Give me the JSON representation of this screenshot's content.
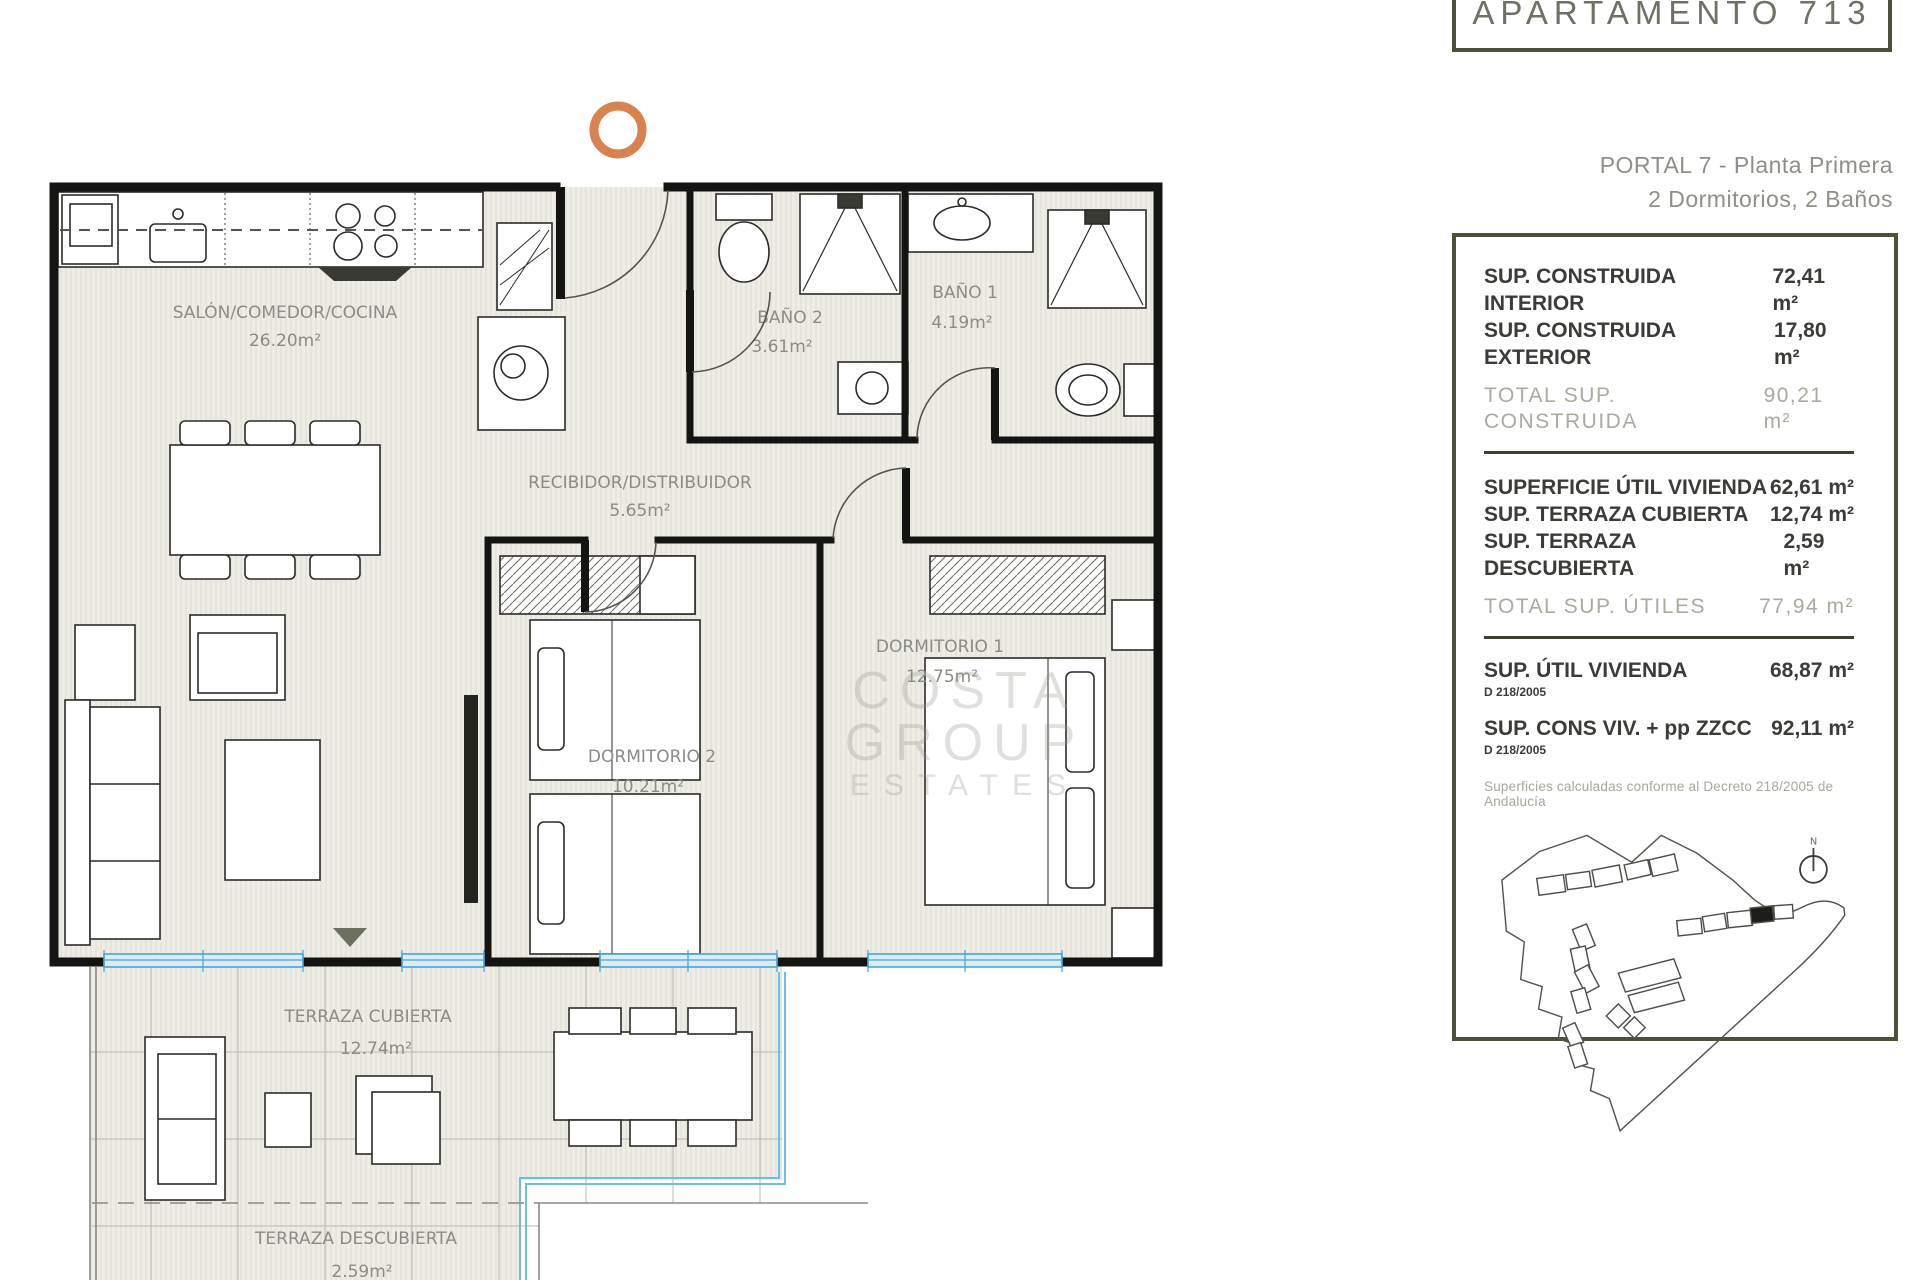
{
  "header": {
    "title": "APARTAMENTO 713",
    "portal_line1": "PORTAL 7 - Planta Primera",
    "portal_line2": "2 Dormitorios, 2 Baños"
  },
  "panel": {
    "construida": [
      {
        "label": "SUP. CONSTRUIDA INTERIOR",
        "value": "72,41 m²"
      },
      {
        "label": "SUP. CONSTRUIDA EXTERIOR",
        "value": "17,80 m²"
      }
    ],
    "total_construida": {
      "label": "TOTAL SUP. CONSTRUIDA",
      "value": "90,21 m²"
    },
    "utiles": [
      {
        "label": "SUPERFICIE ÚTIL VIVIENDA",
        "value": "62,61 m²"
      },
      {
        "label": "SUP. TERRAZA CUBIERTA",
        "value": "12,74 m²"
      },
      {
        "label": "SUP. TERRAZA DESCUBIERTA",
        "value": "2,59 m²"
      }
    ],
    "total_utiles": {
      "label": "TOTAL SUP. ÚTILES",
      "value": "77,94 m²"
    },
    "decreto": [
      {
        "label": "SUP. ÚTIL VIVIENDA",
        "sub": "D 218/2005",
        "value": "68,87 m²"
      },
      {
        "label": "SUP. CONS VIV. + pp ZZCC",
        "sub": "D 218/2005",
        "value": "92,11 m²"
      }
    ],
    "footnote": "Superficies calculadas conforme al Decreto 218/2005 de Andalucía"
  },
  "rooms": {
    "salon": {
      "name": "SALÓN/COMEDOR/COCINA",
      "area": "26.20m²"
    },
    "recibidor": {
      "name": "RECIBIDOR/DISTRIBUIDOR",
      "area": "5.65m²"
    },
    "bano2": {
      "name": "BAÑO 2",
      "area": "3.61m²"
    },
    "bano1": {
      "name": "BAÑO 1",
      "area": "4.19m²"
    },
    "dormitorio1": {
      "name": "DORMITORIO 1",
      "area": "12.75m²"
    },
    "dormitorio2": {
      "name": "DORMITORIO 2",
      "area": "10.21m²"
    },
    "terraza_cubierta": {
      "name": "TERRAZA CUBIERTA",
      "area": "12.74m²"
    },
    "terraza_descubierta": {
      "name": "TERRAZA DESCUBIERTA",
      "area": "2.59m²"
    }
  },
  "map": {
    "north_label": "N"
  },
  "watermark": {
    "line1": "COSTA GROUP",
    "line2": "ESTATES"
  },
  "colors": {
    "accent_orange": "#D9824F",
    "olive_border": "#4C5138",
    "glazing_blue": "#4AA3D4",
    "label_gray": "#8B8B87"
  }
}
